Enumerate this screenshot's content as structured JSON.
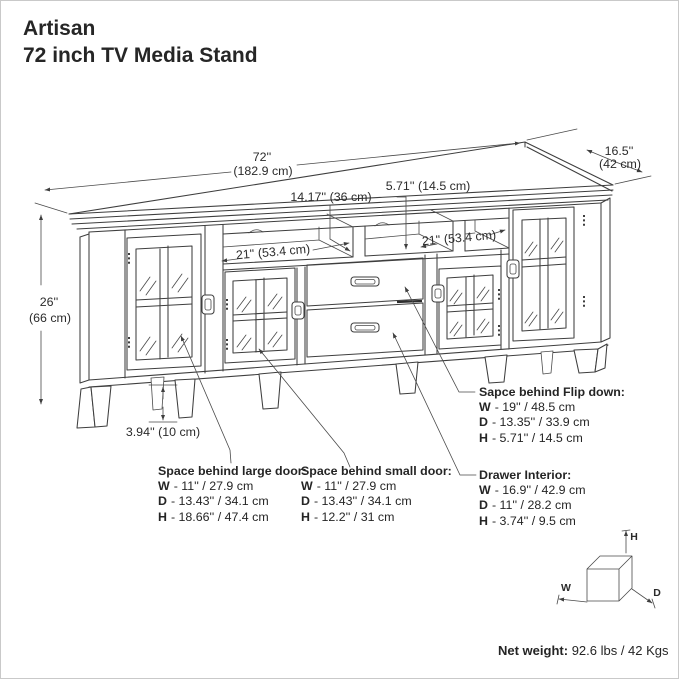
{
  "title": {
    "brand": "Artisan",
    "product": "72 inch TV Media Stand"
  },
  "dimensions": {
    "overall_width_in": "72''",
    "overall_width_cm": "(182.9 cm)",
    "overall_depth_in": "16.5''",
    "overall_depth_cm": "(42 cm)",
    "overall_height_in": "26''",
    "overall_height_cm": "(66 cm)",
    "left_shelf_opening": "21'' (53.4 cm)",
    "right_shelf_opening": "21'' (53.4 cm)",
    "center_shelf_opening": "14.17'' (36 cm)",
    "flip_opening_height": "5.71'' (14.5 cm)",
    "leg_height": "3.94'' (10 cm)"
  },
  "callouts": {
    "flip_down": {
      "title": "Sapce behind Flip down:",
      "rows": [
        {
          "k": "W",
          "v": "- 19'' / 48.5 cm"
        },
        {
          "k": "D",
          "v": "- 13.35'' / 33.9 cm"
        },
        {
          "k": "H",
          "v": "- 5.71'' / 14.5 cm"
        }
      ]
    },
    "large_door": {
      "title": "Space behind large door:",
      "rows": [
        {
          "k": "W",
          "v": "- 11'' / 27.9 cm"
        },
        {
          "k": "D",
          "v": "- 13.43'' / 34.1 cm"
        },
        {
          "k": "H",
          "v": "- 18.66'' / 47.4 cm"
        }
      ]
    },
    "small_door": {
      "title": "Space behind small door:",
      "rows": [
        {
          "k": "W",
          "v": "- 11'' / 27.9 cm"
        },
        {
          "k": "D",
          "v": "- 13.43'' / 34.1 cm"
        },
        {
          "k": "H",
          "v": "- 12.2'' / 31 cm"
        }
      ]
    },
    "drawer": {
      "title": "Drawer Interior:",
      "rows": [
        {
          "k": "W",
          "v": "- 16.9'' / 42.9 cm"
        },
        {
          "k": "D",
          "v": "- 11'' / 28.2 cm"
        },
        {
          "k": "H",
          "v": "- 3.74'' / 9.5 cm"
        }
      ]
    }
  },
  "net_weight": {
    "label": "Net weight:",
    "value": "92.6 lbs / 42 Kgs"
  },
  "axis_cube": {
    "h": "H",
    "w": "W",
    "d": "D"
  }
}
